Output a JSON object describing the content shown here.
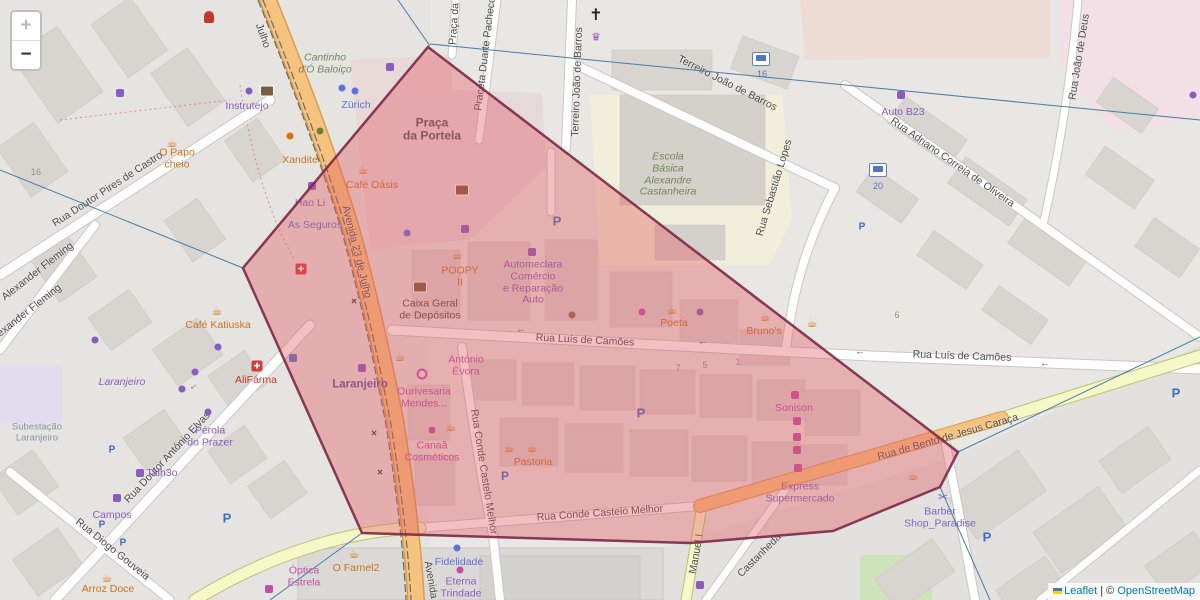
{
  "controls": {
    "zoom_in": "+",
    "zoom_out": "−"
  },
  "attribution": {
    "leaflet_link": "Leaflet",
    "divider": "|",
    "copyright_prefix": "©",
    "osm_link": "OpenStreetMap"
  },
  "selection": {
    "fill": "rgba(226,86,95,0.38)",
    "stroke": "#7c2845",
    "leader": "#4a7ba6"
  },
  "streets": {
    "julho": "Julho",
    "avenida": "Avenida 23 de Julho",
    "avenida_partial": "Avenida",
    "pires": "Rua Doutor Pires de Castro",
    "fleming": "Alexander Fleming",
    "elvas": "Rua Doutor António Elvas",
    "diogo": "Rua Diogo Gouveia",
    "camoes": "Rua Luís de Camões",
    "conde": "Rua Conde Castelo Melhor",
    "bento": "Rua de Bento de Jesus Caraça",
    "terreiro": "Terreiro João de Barros",
    "praceta": "Praceta Duarte Pacheco",
    "praca_da": "Praça da",
    "sebastiao": "Rua Sebastião Lopes",
    "adriano": "Rua Adriano Correia de Oliveira",
    "joao_deus": "Rua João de Deus",
    "manuel": "Manuel I",
    "castanheda": "Castanheda"
  },
  "places": {
    "praca_portela_lines": [
      "Praça",
      "da Portela"
    ],
    "escola_lines": [
      "Escola",
      "Básica",
      "Alexandre",
      "Castanheira"
    ],
    "laranjeiro_station": "Laranjeiro",
    "laranjeiro_place": "Laranjeiro",
    "subestacao_lines": [
      "Subestação",
      "Laranjeiro"
    ]
  },
  "pois": {
    "cantinho_lines": [
      "Cantinho",
      "d'Ó Baloiço"
    ],
    "papo_lines": [
      "O Papo",
      "cheio"
    ],
    "instrutejo": "Instrutejo",
    "zurich": "Zürich",
    "xandite": "Xandite",
    "cafe_oasis": "Café Oásis",
    "hao_li": "Hao Li",
    "seguros": "As Seguros",
    "auto_b23": "Auto B23",
    "caixa_lines": [
      "Caixa Geral",
      "de Depósitos"
    ],
    "poopy_lines": [
      "POOPY",
      "II"
    ],
    "automeclara_lines": [
      "Automeclara",
      "Comércio",
      "e Reparação",
      "Auto"
    ],
    "poeta": "Poeta",
    "brunos": "Bruno's",
    "cafe_katiuska": "Café Katiuska",
    "alifarma": "AliFárma",
    "ourivesaria_lines": [
      "Ourivesaria",
      "Mendes..."
    ],
    "antonio_lines": [
      "António",
      "Évora"
    ],
    "canaa_lines": [
      "Canaã",
      "Cosméticos"
    ],
    "pastoria": "Pastoria",
    "sonison": "Sonison",
    "express_lines": [
      "Express",
      "Supermercado"
    ],
    "barber_lines": [
      "Barber",
      "Shop_Paradise"
    ],
    "perola_lines": [
      "Pérola",
      "do Prazer"
    ],
    "talh3o": "Talh3o",
    "campos": "Campos",
    "arroz_doce": "Arroz Doce",
    "o_farnel2": "O Farnel2",
    "optica_lines": [
      "Óptica",
      "Estrela"
    ],
    "fidelidade": "Fidelidade",
    "eterna_lines": [
      "Eterna",
      "Trindade"
    ]
  },
  "house_numbers": {
    "n7": "7",
    "n5": "5",
    "n1": "1",
    "n6": "6",
    "n16": "16"
  },
  "transit": {
    "bus16": "16",
    "bus20": "20"
  },
  "misc": {
    "parking": "P",
    "arrow_left": "←",
    "crossing": "×"
  },
  "icons": {
    "cafe": "☕",
    "church_cross": "✝",
    "crown": "♛",
    "pharmacy_cross": "✚",
    "scissors": "✂"
  }
}
